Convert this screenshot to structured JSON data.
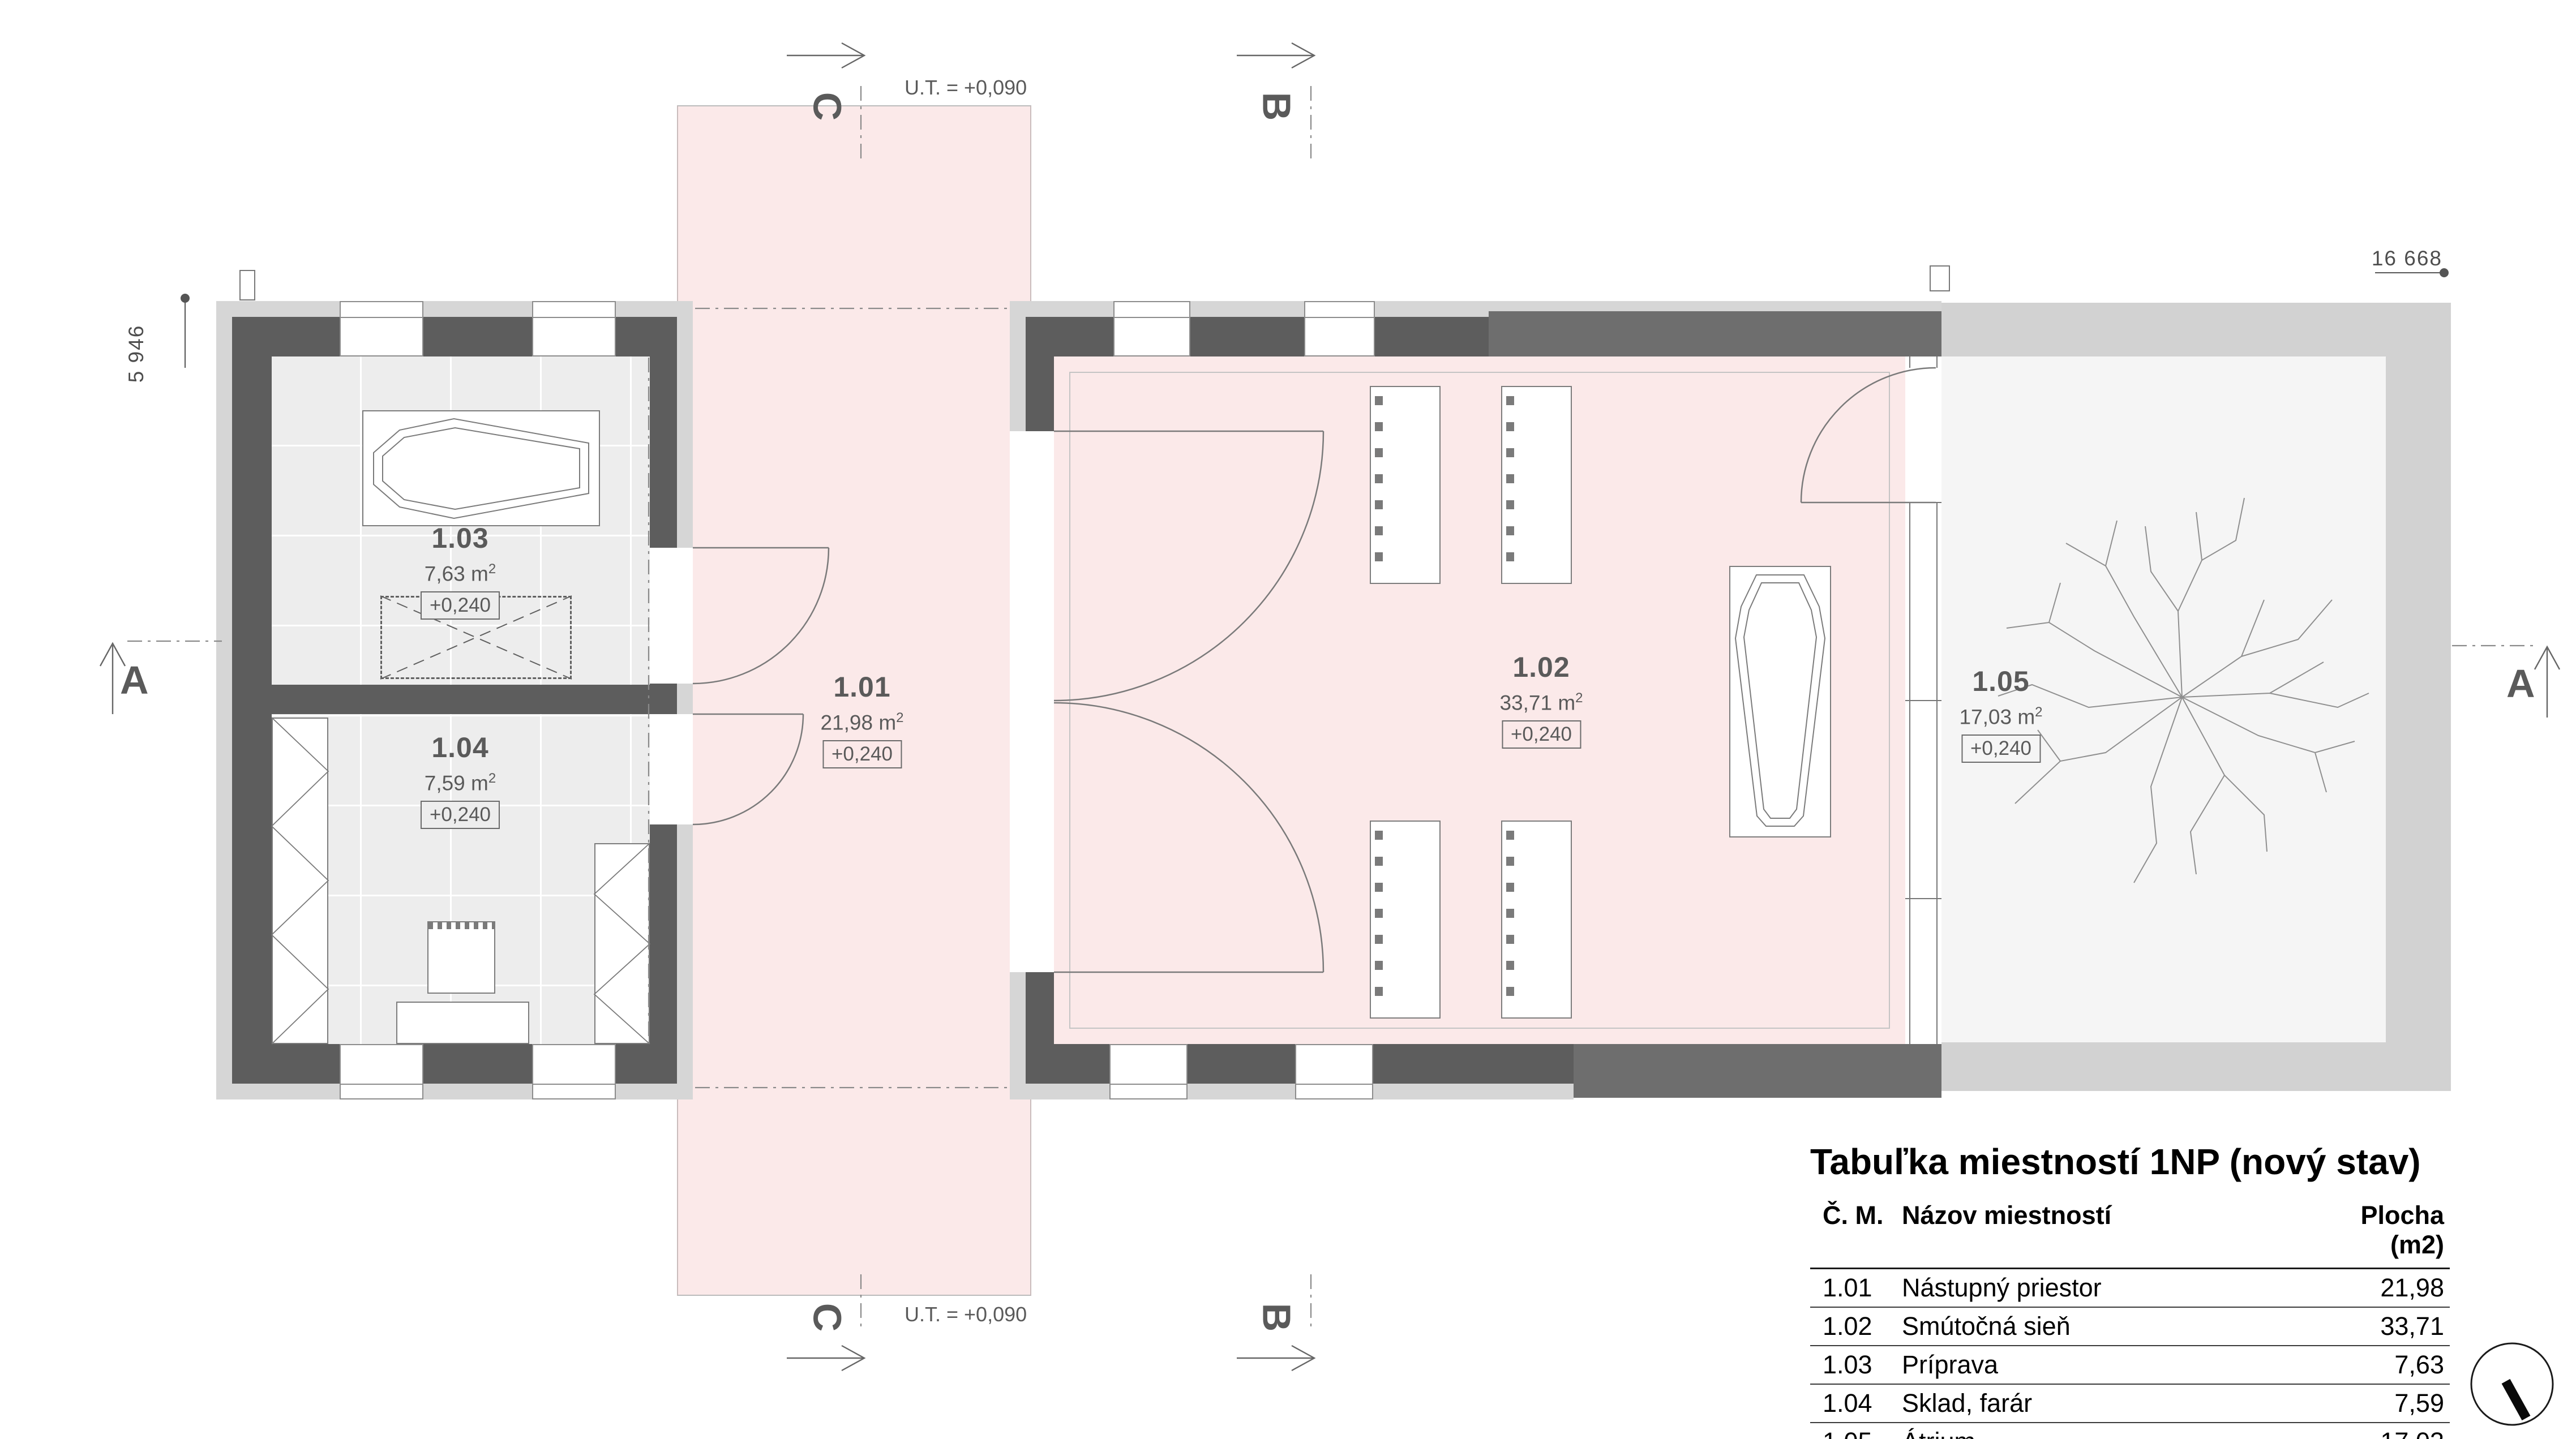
{
  "plan": {
    "rooms": [
      {
        "number": "1.01",
        "area": "21,98",
        "area_unit": "m",
        "area_sup": "2",
        "elevation": "+0,240"
      },
      {
        "number": "1.02",
        "area": "33,71",
        "area_unit": "m",
        "area_sup": "2",
        "elevation": "+0,240"
      },
      {
        "number": "1.03",
        "area": "7,63",
        "area_unit": "m",
        "area_sup": "2",
        "elevation": "+0,240"
      },
      {
        "number": "1.04",
        "area": "7,59",
        "area_unit": "m",
        "area_sup": "2",
        "elevation": "+0,240"
      },
      {
        "number": "1.05",
        "area": "17,03",
        "area_unit": "m",
        "area_sup": "2",
        "elevation": "+0,240"
      }
    ],
    "sections": {
      "a": "A",
      "b": "B",
      "c": "C"
    },
    "ut_label": "U.T. = +0,090",
    "dimensions": {
      "left": "5 946",
      "top_right": "16 668"
    }
  },
  "table": {
    "title": "Tabuľka miestností 1NP (nový stav)",
    "headers": {
      "number": "Č. M.",
      "name": "Názov miestností",
      "area": "Plocha (m2)"
    },
    "rows": [
      {
        "number": "1.01",
        "name": "Nástupný priestor",
        "area": "21,98"
      },
      {
        "number": "1.02",
        "name": "Smútočná sieň",
        "area": "33,71"
      },
      {
        "number": "1.03",
        "name": "Príprava",
        "area": "7,63"
      },
      {
        "number": "1.04",
        "name": "Sklad, farár",
        "area": "7,59"
      },
      {
        "number": "1.05",
        "name": "Átrium",
        "area": "17,03"
      }
    ],
    "total": "87,94 m²"
  },
  "icons": {
    "logo": "north-arrow-icon"
  },
  "colors": {
    "wall": "#5d5d5d",
    "wall_new": "#6e6e6e",
    "render": "#d6d6d6",
    "floor": "#ededed",
    "highlight_pink": "#fbe9e9",
    "atrium_wall": "#d2d2d2",
    "atrium_floor": "#f5f5f5",
    "line": "#777777",
    "text": "#5a5a5a"
  }
}
